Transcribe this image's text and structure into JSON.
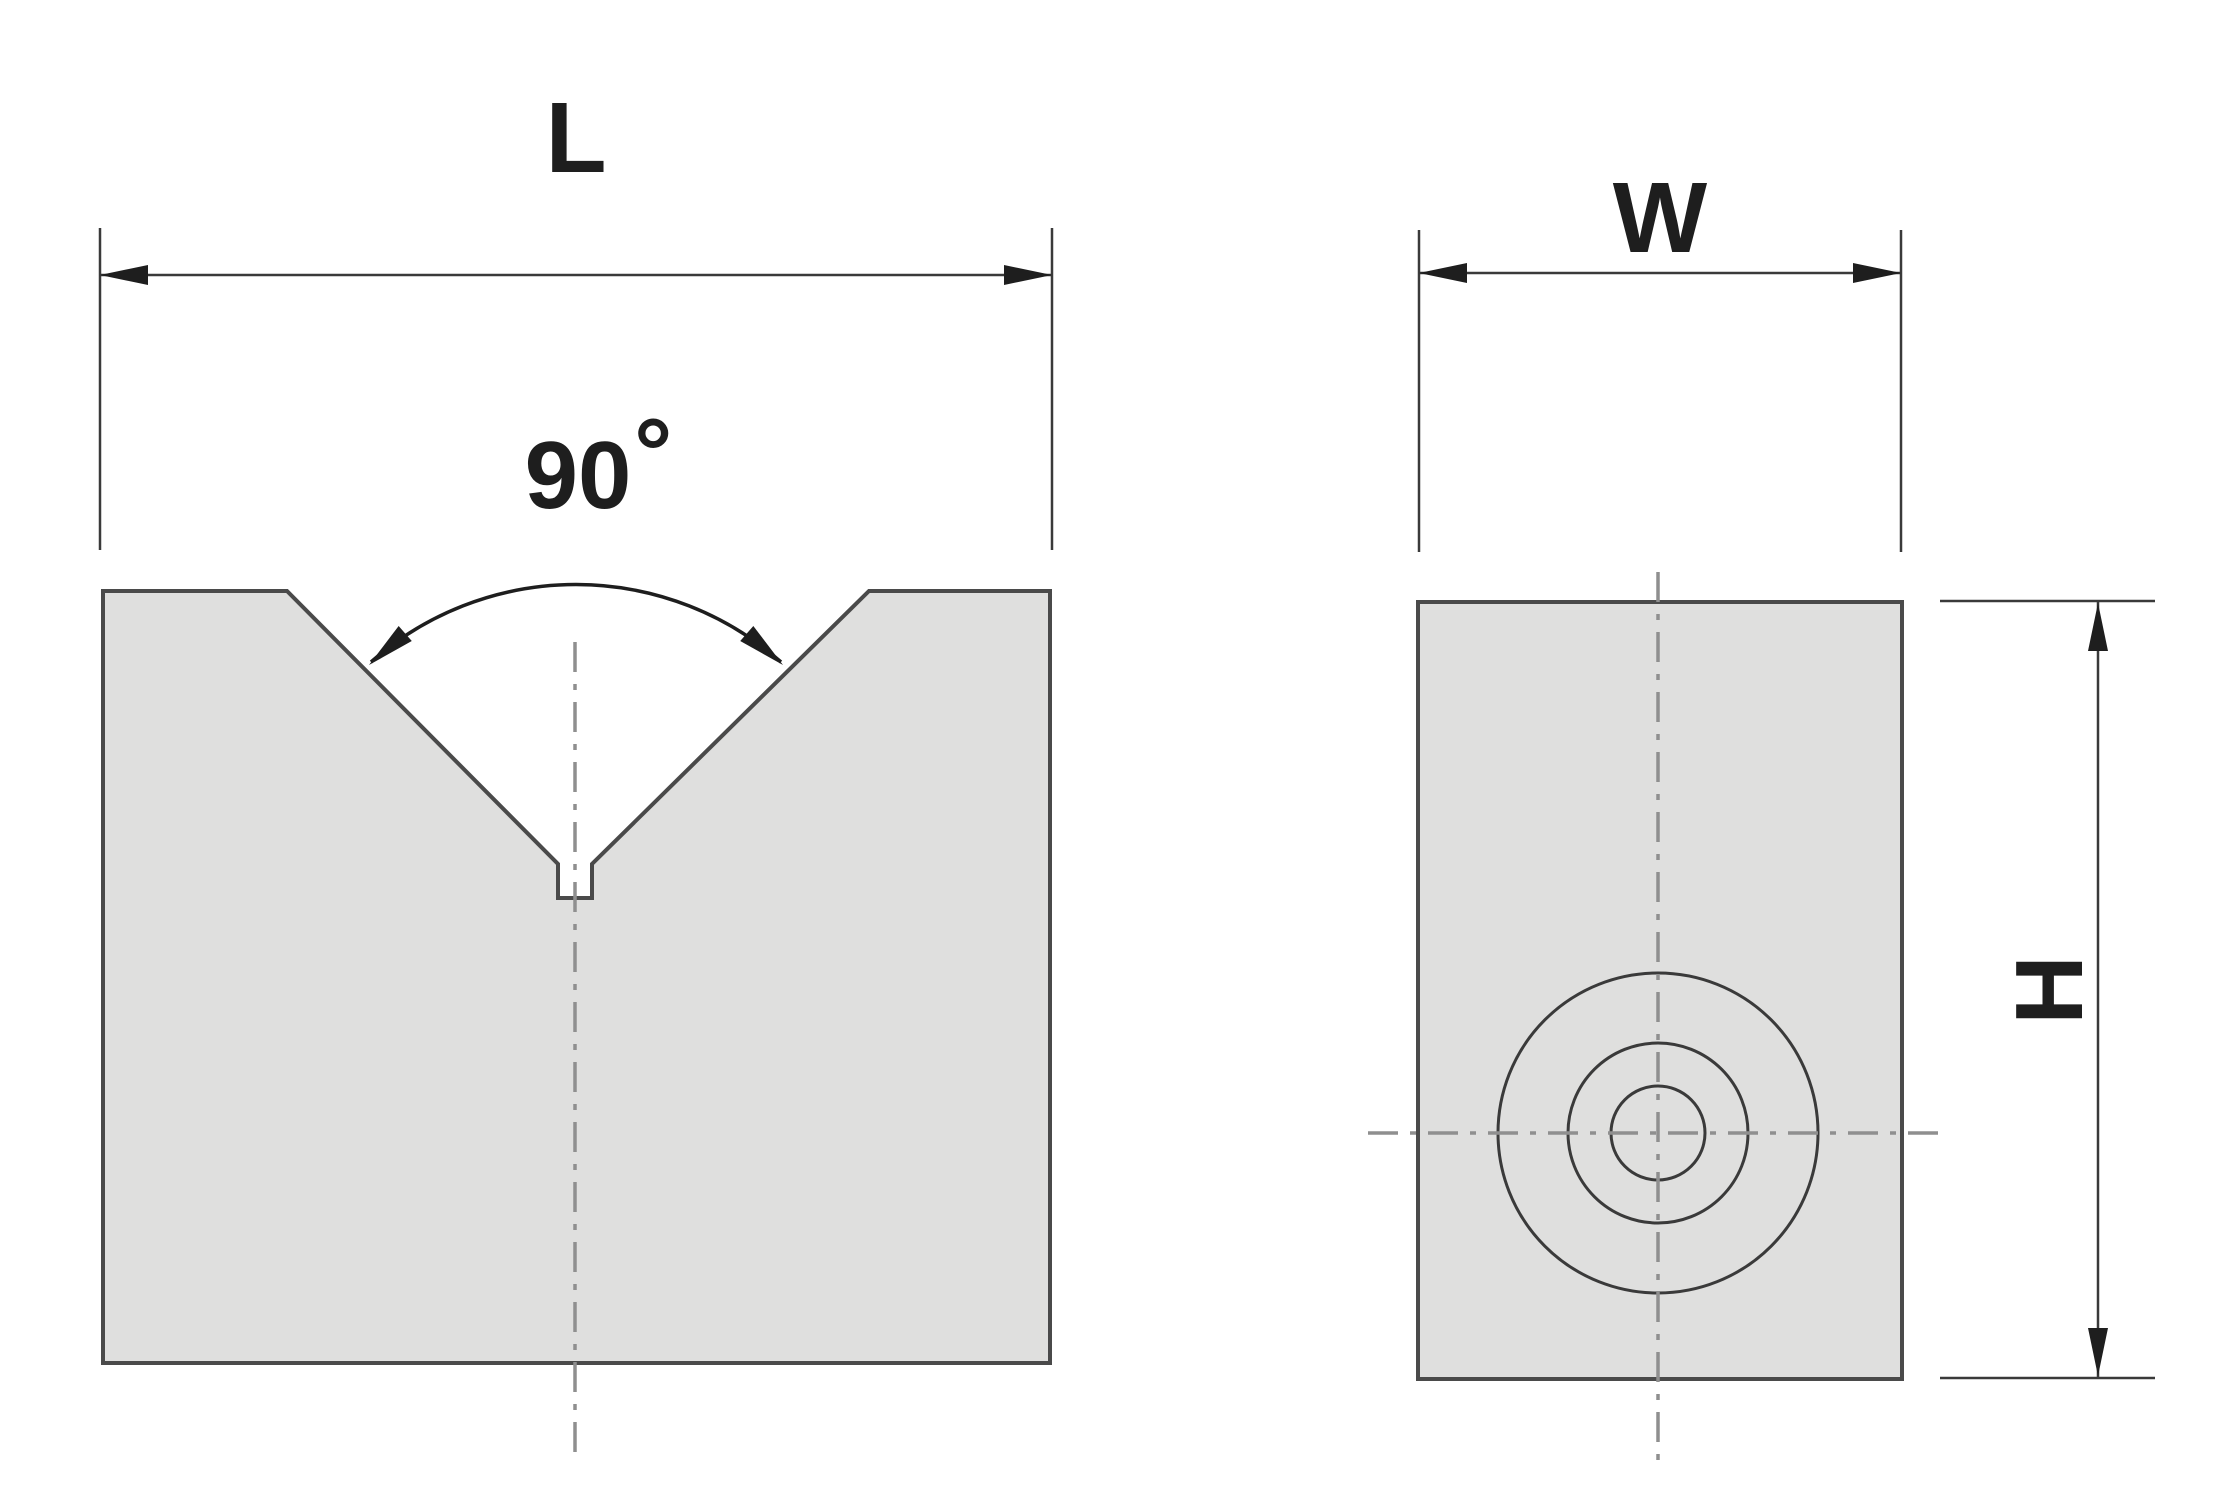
{
  "palette": {
    "background": "#ffffff",
    "block_fill": "#dfdfde",
    "block_outline": "#4a4a4a",
    "dimension": "#3a3a3a",
    "centerline": "#8f8f8f",
    "text": "#1e1e1e"
  },
  "front_view": {
    "length_label": "L",
    "angle_value": "90",
    "degree_symbol": "°"
  },
  "side_view": {
    "width_label": "W",
    "height_label": "H"
  }
}
